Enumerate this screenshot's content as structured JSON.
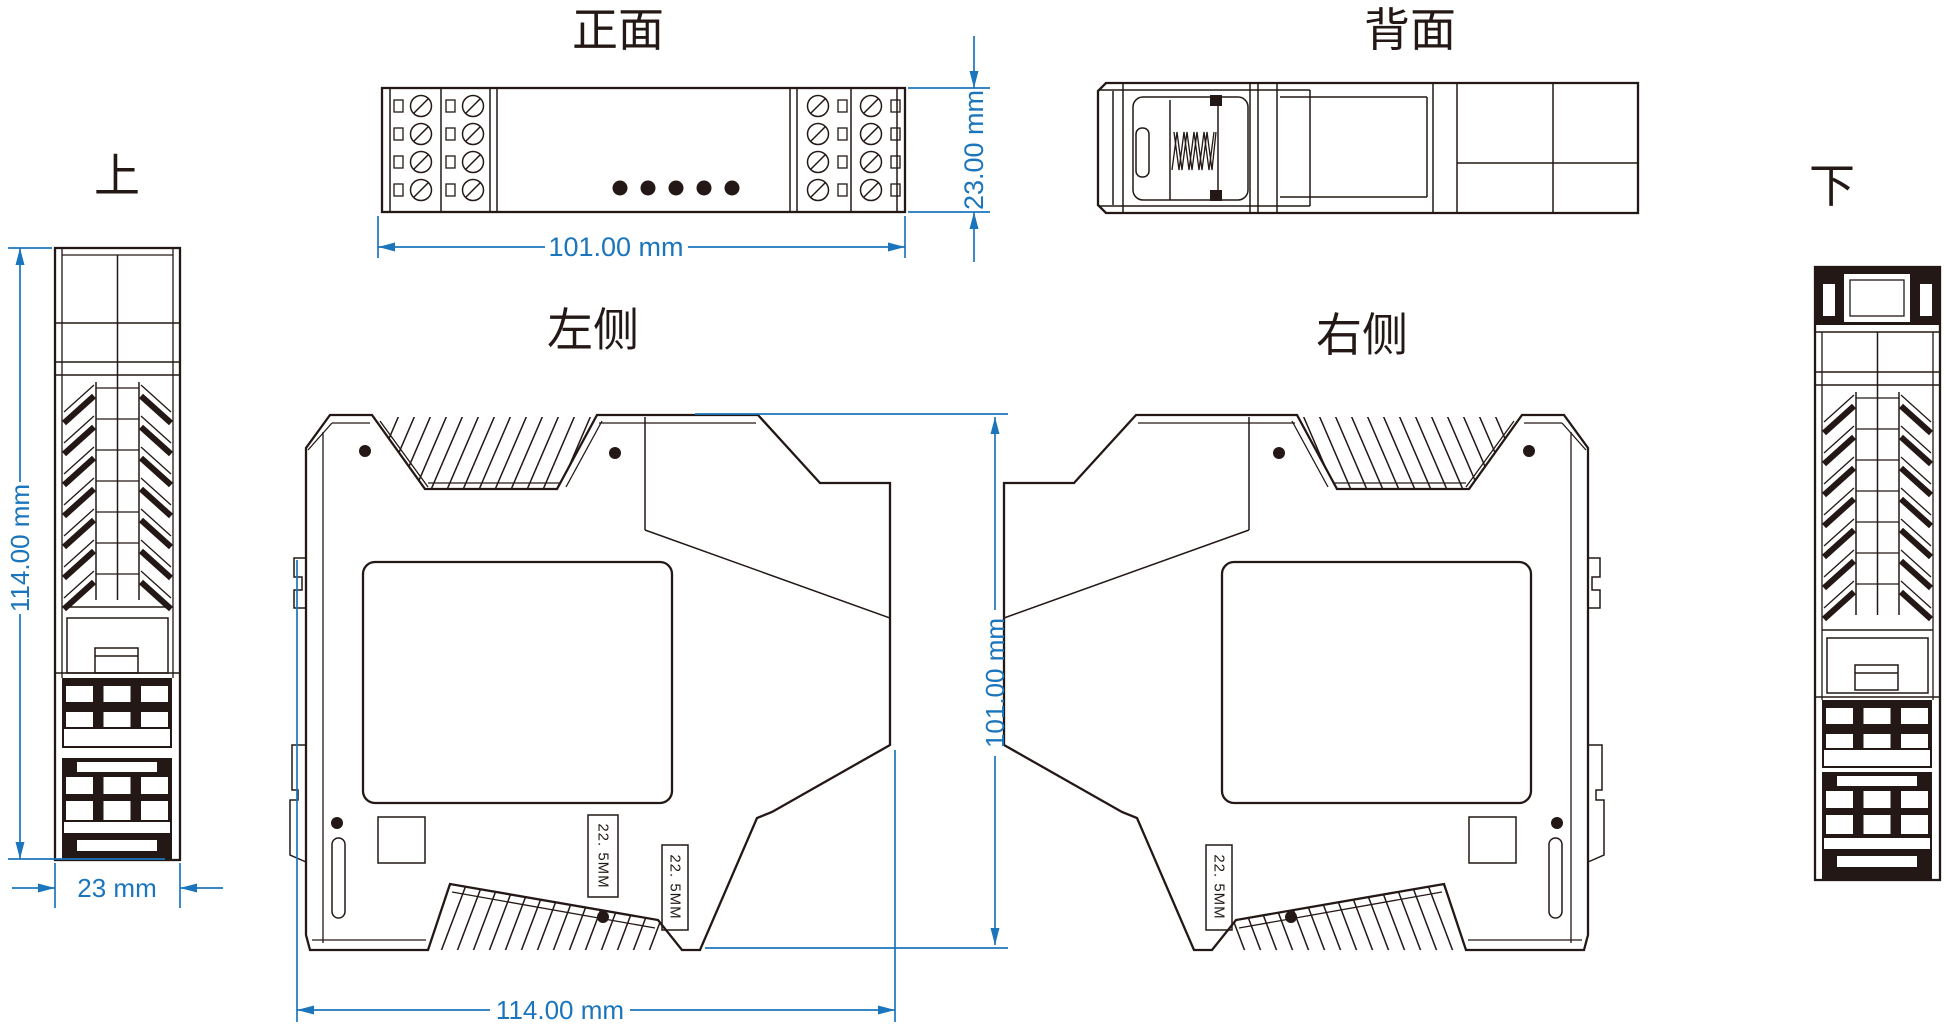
{
  "drawing": {
    "title_views": {
      "front": {
        "label": "正面"
      },
      "back": {
        "label": "背面"
      },
      "top": {
        "label": "上"
      },
      "bottom": {
        "label": "下"
      },
      "left_side": {
        "label": "左侧"
      },
      "right_side": {
        "label": "右侧"
      }
    },
    "dims": {
      "front_width": "101.00 mm",
      "front_height": "23.00 mm",
      "top_view_height": "114.00 mm",
      "top_view_width": "23 mm",
      "side_height": "101.00 mm",
      "side_width": "114.00 mm",
      "din_label_a": "22. 5MM",
      "din_label_b": "22. 5MM",
      "din_label_right": "22. 5MM"
    },
    "colors": {
      "line": "#231815",
      "dimension": "#1b75bc",
      "background": "#ffffff"
    }
  }
}
